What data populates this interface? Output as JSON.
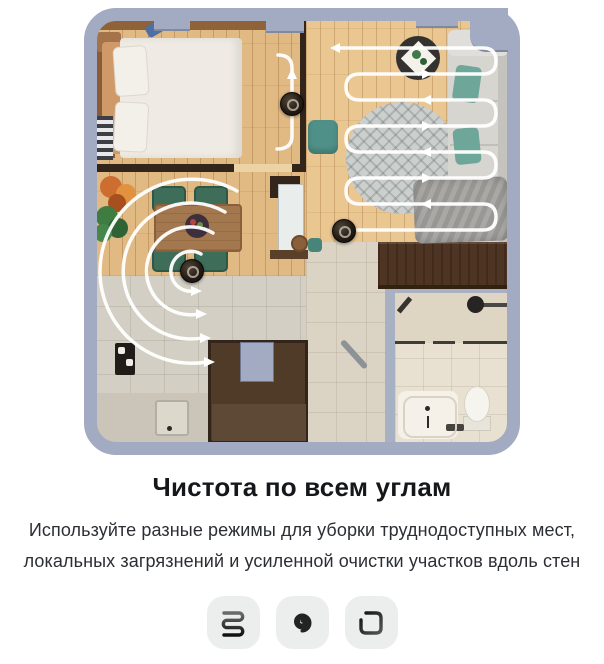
{
  "card": {
    "title": "Чистота по всем углам",
    "subtitle_line1": "Используйте разные режимы для уборки трудно­доступных мест,",
    "subtitle_line2": "локальных загрязнений и усиленной очистки участков вдоль стен"
  },
  "modes": [
    {
      "id": "zigzag-mode",
      "icon": "zigzag-path-icon"
    },
    {
      "id": "spiral-mode",
      "icon": "spiral-path-icon"
    },
    {
      "id": "perimeter-mode",
      "icon": "perimeter-path-icon"
    }
  ],
  "illustration": {
    "kind": "apartment floor plan with robot vacuum cleaning routes",
    "rooms": [
      "bedroom",
      "living-room",
      "dining-area",
      "kitchen",
      "hallway",
      "bathroom"
    ],
    "robots_visible": 3,
    "route_shapes": [
      "wall-follow line",
      "serpentine zigzag",
      "expanding spiral"
    ]
  },
  "colors": {
    "outer_wall": "#a2abc2",
    "wood_floor": "#eac690",
    "tile_floor": "#d3cfc4",
    "route_path": "#ffffff",
    "accent_teal": "#6ea69a",
    "icon_tile_bg": "#eceded",
    "title_text": "#15171a",
    "body_text": "#2b2e33"
  }
}
